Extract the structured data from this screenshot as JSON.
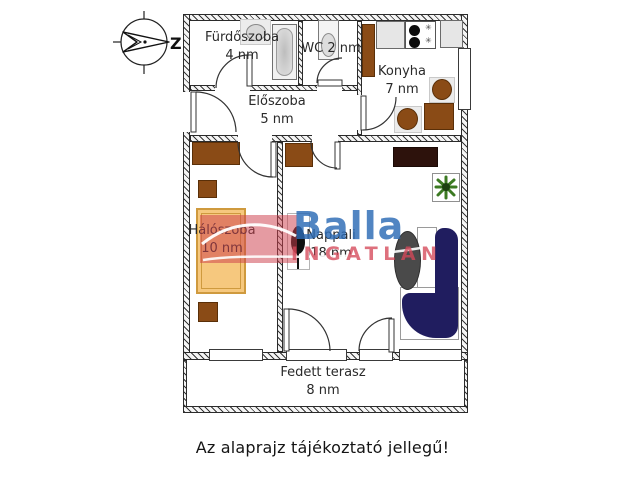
{
  "caption": "Az alaprajz tájékoztató jellegű!",
  "compass": {
    "direction_label": "Z"
  },
  "watermark": {
    "brand_line1": "Balla",
    "brand_line2": "INGATLAN",
    "blue": "#2b6ab4",
    "red": "#d54858"
  },
  "rooms": {
    "bathroom": {
      "name": "Fürdőszoba",
      "area": "4 nm"
    },
    "wc": {
      "label": "WC 2 nm"
    },
    "kitchen": {
      "name": "Konyha",
      "area": "7 nm"
    },
    "hall": {
      "name": "Előszoba",
      "area": "5 nm"
    },
    "bedroom": {
      "name": "Hálószoba",
      "area": "10 nm"
    },
    "living_room": {
      "name": "Nappali",
      "area": "18 nm"
    },
    "terrace": {
      "name": "Fedett terasz",
      "area": "8 nm"
    }
  },
  "icons": {
    "burner_symbol": "✳"
  },
  "colors": {
    "furniture_brown": "#8a4b16",
    "tv_dark": "#2d120c",
    "sofa_navy": "#201d5f",
    "bed_fill": "#f6c87e",
    "bed_border": "#cf9a3e",
    "plant_green": "#3c7a22",
    "coffee_table_gray": "#4a4a4a"
  }
}
